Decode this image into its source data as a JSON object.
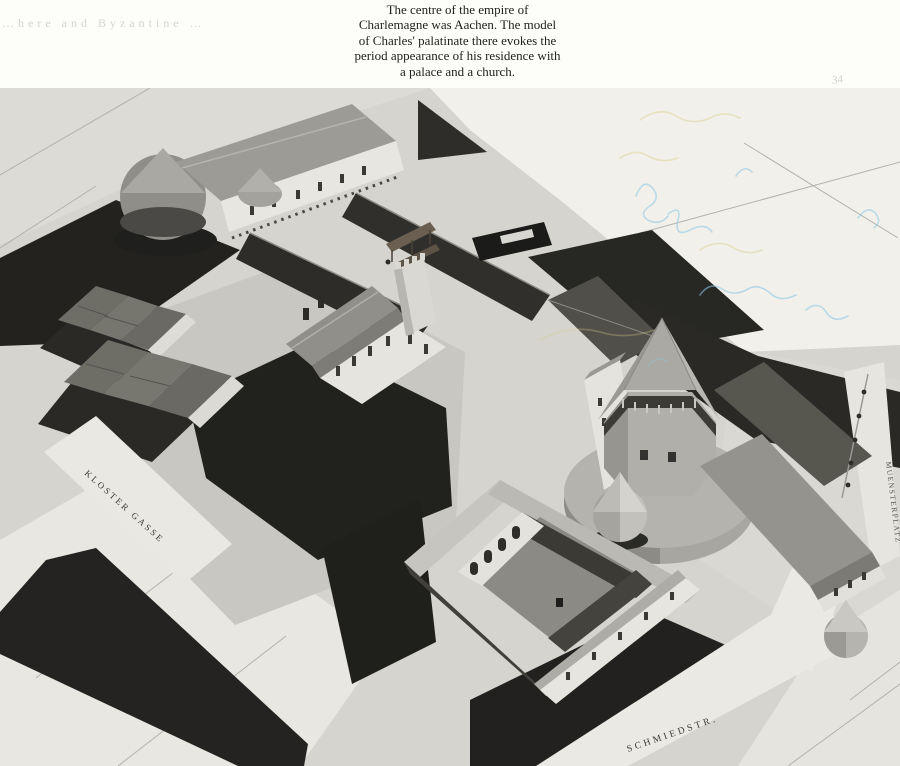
{
  "page": {
    "cropped_header_text": "…here and Byzantine …",
    "handwritten_page_mark": "34",
    "caption": "The centre of the empire of\nCharlemagne was Aachen. The model\nof Charles' palatinate there evokes the\nperiod appearance of his residence with\na palace and a church."
  },
  "photo": {
    "alt": "Aerial photograph of the model of Charlemagne's palatinate at Aachen: palace hall, connecting galleries, gatehouse, cloister and octagonal chapel",
    "street_labels": {
      "kloster_gasse": "KLOSTER GASSE",
      "schmiedstrasse": "SCHMIEDSTR.",
      "muensterplatz": "MUENSTERPLATZ"
    },
    "palette": {
      "photo_background": "#d5d4cf",
      "base_light": "#e9e8e2",
      "shadow_dark": "#232220",
      "roof_grey": "#908f89",
      "wall_white": "#e7e6e0",
      "scribble_blue": "#8ec8e6",
      "scribble_yellow": "#d9cf8e"
    }
  }
}
